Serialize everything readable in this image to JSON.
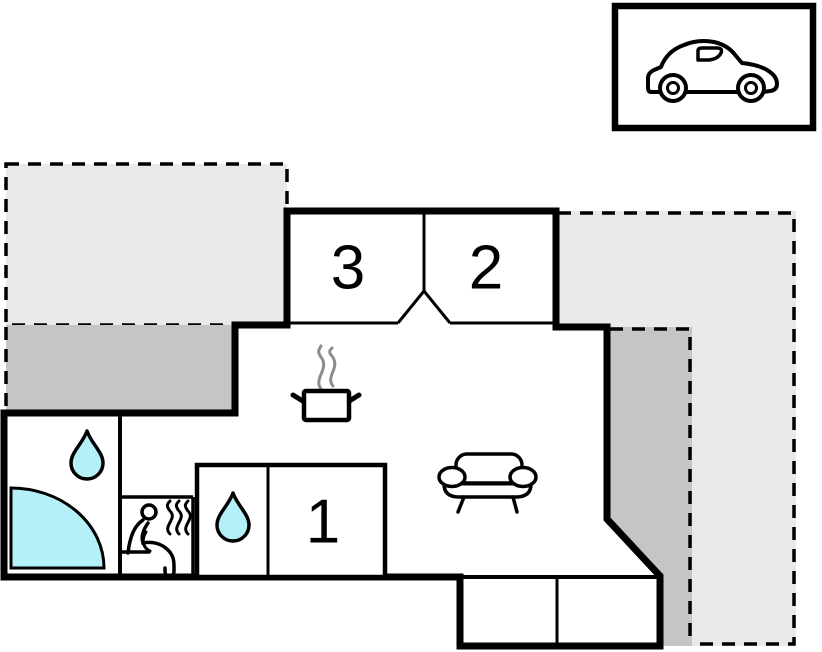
{
  "plan_title": "holiday-home-floor-plan",
  "room_labels": {
    "bedroom_3": "3",
    "bedroom_2": "2",
    "bedroom_1": "1"
  },
  "colors": {
    "open_terrace": "#e9e9e9",
    "covered_terrace": "#c5c5c5",
    "water": "#b4f0f8",
    "walls": "#000000",
    "steam": "#8c8c8c",
    "background": "#ffffff"
  },
  "icons": {
    "garage": "car-icon",
    "living_room": "sofa-icon",
    "kitchen": "cooking-pot-icon",
    "bathroom": "water-drop-icon",
    "wc": "water-drop-icon",
    "sauna": "sauna-person-icon",
    "bath": "corner-bathtub-icon"
  }
}
